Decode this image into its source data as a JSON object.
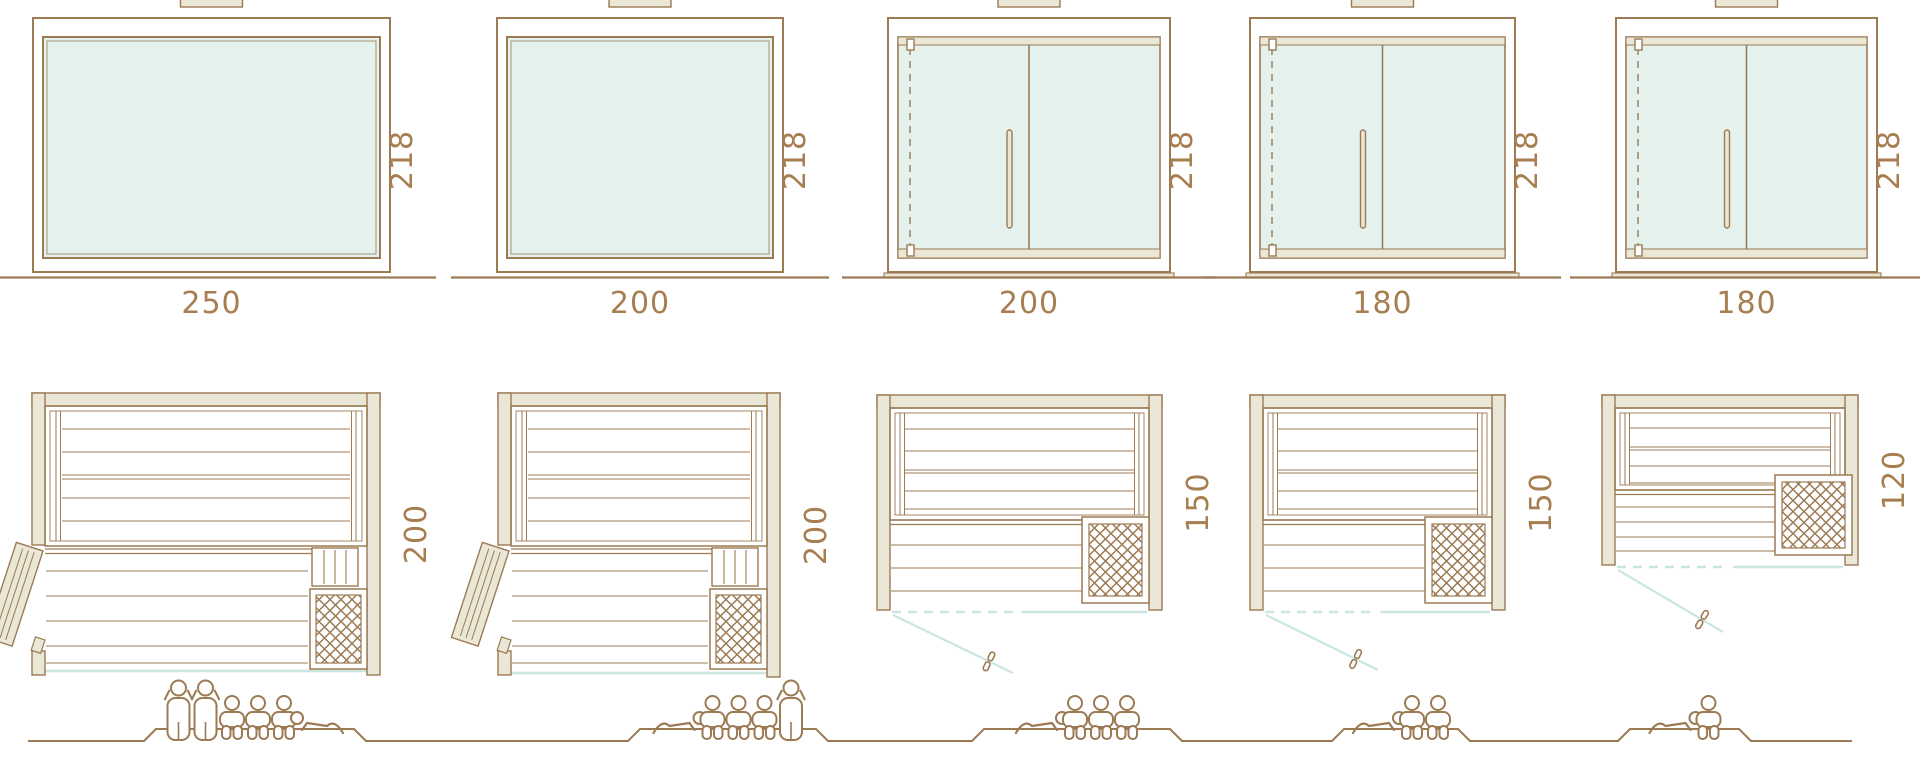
{
  "diagram": {
    "kind": "sauna-size-comparison",
    "colors": {
      "line": "#9b7a54",
      "wood": "#eae7d6",
      "glass": "#e4f1ed",
      "accent": "#cbe6e1",
      "label": "#a67e4f",
      "background": "#ffffff"
    },
    "units": [
      {
        "name": "sauna-250x200",
        "front": {
          "width": "250",
          "height": "218",
          "glazing": "fixed-glass-front"
        },
        "plan": {
          "depth": "200",
          "door": "side-hinged-wood-door",
          "heater": "corner-heater"
        },
        "capacity": {
          "standing": 2,
          "sitting": 3,
          "lying": 1
        }
      },
      {
        "name": "sauna-200x200",
        "front": {
          "width": "200",
          "height": "218",
          "glazing": "fixed-glass-front"
        },
        "plan": {
          "depth": "200",
          "door": "side-hinged-wood-door",
          "heater": "corner-heater"
        },
        "capacity": {
          "standing": 1,
          "sitting": 3,
          "lying": 1
        }
      },
      {
        "name": "sauna-200x150",
        "front": {
          "width": "200",
          "height": "218",
          "glazing": "glass-door-front"
        },
        "plan": {
          "depth": "150",
          "door": "front-glass-door",
          "heater": "corner-heater"
        },
        "capacity": {
          "standing": 0,
          "sitting": 3,
          "lying": 1
        }
      },
      {
        "name": "sauna-180x150",
        "front": {
          "width": "180",
          "height": "218",
          "glazing": "glass-door-front"
        },
        "plan": {
          "depth": "150",
          "door": "front-glass-door",
          "heater": "corner-heater"
        },
        "capacity": {
          "standing": 0,
          "sitting": 2,
          "lying": 1
        }
      },
      {
        "name": "sauna-180x120",
        "front": {
          "width": "180",
          "height": "218",
          "glazing": "glass-door-front"
        },
        "plan": {
          "depth": "120",
          "door": "front-glass-door",
          "heater": "side-heater"
        },
        "capacity": {
          "standing": 0,
          "sitting": 1,
          "lying": 1
        }
      }
    ]
  }
}
